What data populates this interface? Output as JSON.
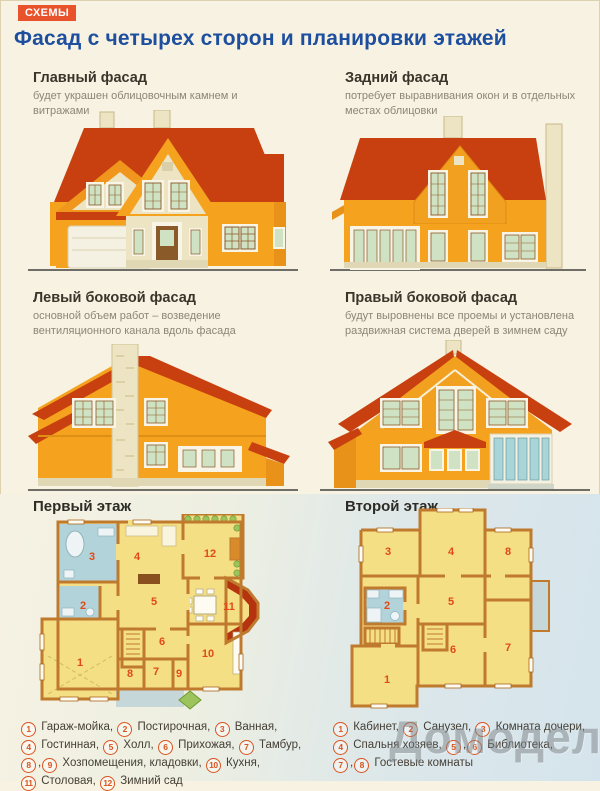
{
  "page": {
    "badge": "СХЕМЫ",
    "title": "Фасад с четырех сторон и планировки этажей",
    "watermark": "Домодел"
  },
  "facade_sections": [
    {
      "heading": "Главный фасад",
      "desc": "будет украшен облицовочным камнем и витражами"
    },
    {
      "heading": "Задний фасад",
      "desc": "потребует выравнивания окон и в отдельных местах облицовки"
    },
    {
      "heading": "Левый боковой фасад",
      "desc": "основной объем работ – возведение вентиляционного канала вдоль фасада"
    },
    {
      "heading": "Правый боковой фасад",
      "desc": "будут выровнены все проемы и установлена раздвижная система дверей в зимнем саду"
    }
  ],
  "plans": {
    "first": {
      "heading": "Первый этаж",
      "rooms": [
        "1",
        "2",
        "3",
        "4",
        "5",
        "6",
        "7",
        "8",
        "9",
        "10",
        "11",
        "12"
      ]
    },
    "second": {
      "heading": "Второй этаж",
      "rooms": [
        "1",
        "2",
        "3",
        "4",
        "5",
        "6",
        "7",
        "8"
      ]
    }
  },
  "legends": {
    "first": {
      "lines": [
        [
          {
            "n": [
              "1"
            ],
            "t": "Гараж-мойка,"
          },
          {
            "n": [
              "2"
            ],
            "t": "Постирочная,"
          },
          {
            "n": [
              "3"
            ],
            "t": "Ванная,"
          }
        ],
        [
          {
            "n": [
              "4"
            ],
            "t": "Гостинная,"
          },
          {
            "n": [
              "5"
            ],
            "t": "Холл,"
          },
          {
            "n": [
              "6"
            ],
            "t": "Прихожая,"
          },
          {
            "n": [
              "7"
            ],
            "t": "Тамбур,"
          }
        ],
        [
          {
            "n": [
              "8",
              "9"
            ],
            "t": "Хозпомещения, кладовки,"
          },
          {
            "n": [
              "10"
            ],
            "t": "Кухня,"
          }
        ],
        [
          {
            "n": [
              "11"
            ],
            "t": "Столовая,"
          },
          {
            "n": [
              "12"
            ],
            "t": "Зимний сад"
          }
        ]
      ]
    },
    "second": {
      "lines": [
        [
          {
            "n": [
              "1"
            ],
            "t": "Кабинет,"
          },
          {
            "n": [
              "2"
            ],
            "t": "Санузел,"
          },
          {
            "n": [
              "3"
            ],
            "t": "Комната дочери,"
          }
        ],
        [
          {
            "n": [
              "4"
            ],
            "t": "Спальня хозяев,"
          },
          {
            "n": [
              "5",
              "6"
            ],
            "t": "Библиотека,"
          }
        ],
        [
          {
            "n": [
              "7",
              "8"
            ],
            "t": "Гостевые комнаты"
          }
        ]
      ]
    }
  },
  "colors": {
    "badge_bg": "#e9532b",
    "title_blue": "#1e4f9f",
    "wall_orange": "#f5a31f",
    "roof_red": "#c8400f",
    "stone_cream": "#ece4c2",
    "window_pane_green": "#cfe2c3",
    "plan_room_yellow": "#f4df85",
    "plan_wall_brown": "#bf7a2e",
    "plan_blue_room": "#b2d3da",
    "plan_bay_red": "#b5330e",
    "legend_number_red": "#d9541f",
    "bottom_blue": "#d5e4ec"
  }
}
